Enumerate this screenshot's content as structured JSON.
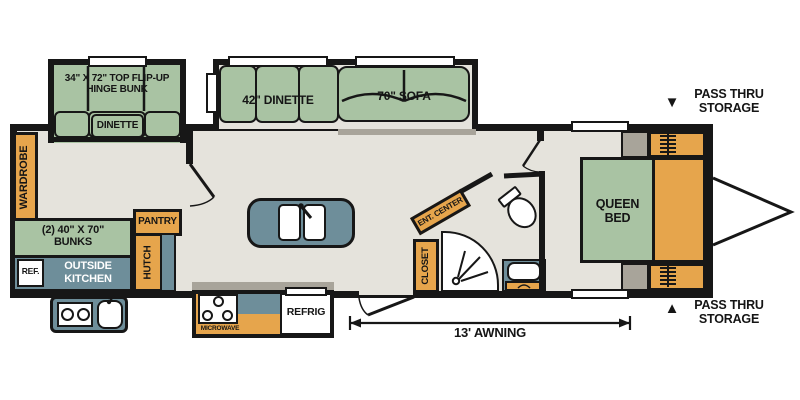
{
  "title": "Travel trailer floor plan",
  "colors": {
    "wall": "#171717",
    "floor": "#e5e3dc",
    "green": "#a9c3a3",
    "orange": "#e6a54c",
    "teal": "#6e8e9a",
    "gray": "#a8a49a",
    "white": "#ffffff"
  },
  "slide_bunk": {
    "label_line1": "34\" X 72\" TOP FLIP-UP",
    "label_line2": "HINGE BUNK",
    "dinette_label": "DINETTE"
  },
  "slide_main": {
    "dinette_label": "42\" DINETTE",
    "sofa_label": "70\" SOFA"
  },
  "left_side": {
    "wardrobe": "WARDROBE",
    "bunks_line1": "(2) 40\" X 70\"",
    "bunks_line2": "BUNKS",
    "outside_kitchen_line1": "OUTSIDE",
    "outside_kitchen_line2": "KITCHEN",
    "ref": "REF.",
    "pantry": "PANTRY",
    "hutch": "HUTCH"
  },
  "kitchen": {
    "microwave": "MICROWAVE",
    "refrig": "REFRIG"
  },
  "bath": {
    "ent_center": "ENT. CENTER",
    "closet": "CLOSET"
  },
  "bedroom": {
    "queen_line1": "QUEEN",
    "queen_line2": "BED"
  },
  "annotations": {
    "awning": "13' AWNING",
    "pass_thru_top_line1": "PASS THRU",
    "pass_thru_top_line2": "STORAGE",
    "pass_thru_bottom_line1": "PASS THRU",
    "pass_thru_bottom_line2": "STORAGE",
    "arrow_down": "▼",
    "arrow_up": "▲"
  }
}
